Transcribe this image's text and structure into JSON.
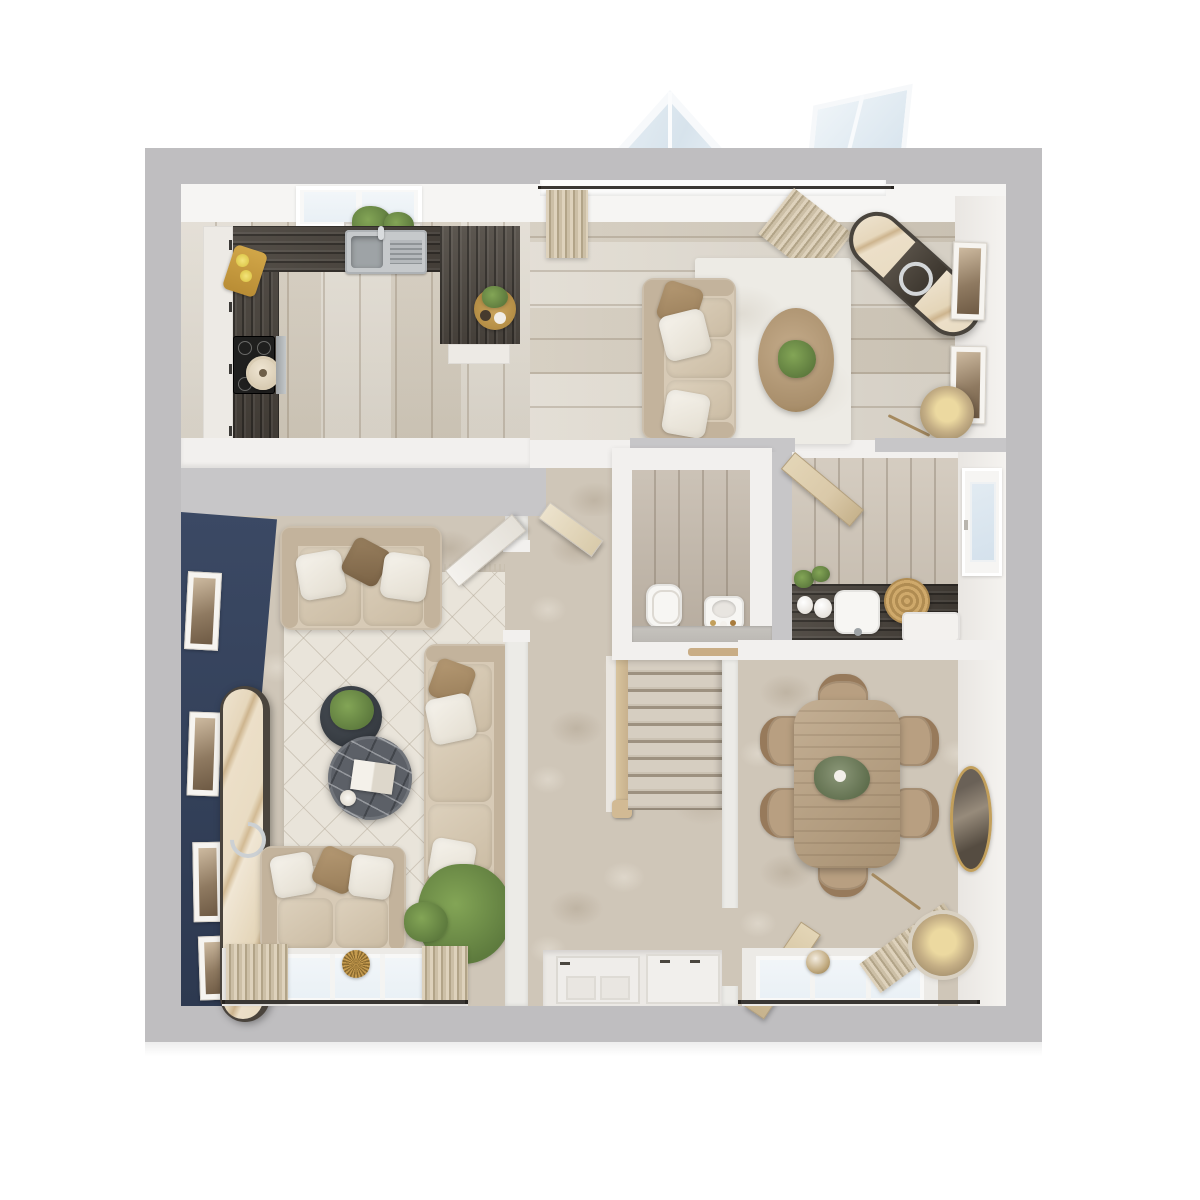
{
  "meta": {
    "kind": "3d-floor-plan-render",
    "view": "top-down-dollhouse",
    "text_visible": false
  },
  "palette": {
    "page_bg": "#ffffff",
    "wall_outer": "#bfbec0",
    "wall_core": "#c7c6c8",
    "wall_face": "#f2f0ee",
    "ceiling_face": "#f6f5f3",
    "wood_floor": "#d7d0c3",
    "wood_wc": "#c2b7a9",
    "counter_dark": "#453f38",
    "cabinet_white": "#edeae5",
    "carpet": "#cfc6b8",
    "navy_wall": "#3b4964",
    "navy_dark": "#2d3950",
    "rug_light": "#e9e4da",
    "rug_family": "#edebe5",
    "sofa": "#d7cab6",
    "sofa_shade": "#c3b39c",
    "pillow_white": "#f3f0ea",
    "pillow_tan": "#a98c66",
    "pillow_brown": "#8b7152",
    "table_wood": "#b69d7c",
    "chair_wood": "#b89f81",
    "marble_dark": "#5c6067",
    "gold": "#c29f5b",
    "glass": "#e9f0f5",
    "glass_blue": "#d4e1ec",
    "curtain": "#cfc2ab",
    "stair_rail": "#c8b18d",
    "door_wood": "#dac9a9",
    "door_white": "#efedea",
    "rod_dark": "#3a3733",
    "plant_green": "#5e7b3e",
    "plant_light": "#83a556",
    "stone": "#bcb9b4",
    "steel": "#c6c9cb"
  },
  "structure": {
    "rooms": [
      {
        "id": "kitchen",
        "position": "top-left",
        "floor": "light-timber",
        "fixtures": [
          "u-shaped-dark-worktop",
          "white-cabinet-run",
          "inset-sink-with-drainer",
          "induction-hob",
          "stock-pot",
          "chopping-board-with-lemons",
          "round-serving-board",
          "round-herb-board",
          "roof-window",
          "herb-planter"
        ]
      },
      {
        "id": "family-area",
        "position": "top-right",
        "floor": "light-timber",
        "fixtures": [
          "three-seat-sofa",
          "oval-timber-coffee-table",
          "potted-plant",
          "area-rug",
          "angled-marble-console",
          "floor-lamp",
          "two-wall-frames",
          "window-with-curtains",
          "roof-lantern-above"
        ]
      },
      {
        "id": "living-room",
        "position": "bottom-left",
        "floor": "carpet",
        "fixtures": [
          "navy-accent-wall",
          "four-wall-frames",
          "marble-capsule-console",
          "two-seat-sofa-top",
          "three-seat-sofa-right",
          "loveseat",
          "round-marble-coffee-table",
          "round-dark-side-table",
          "diamond-pattern-rug",
          "potted-plant",
          "window-with-curtains",
          "sunburst-ornament"
        ]
      },
      {
        "id": "hall",
        "position": "centre",
        "floor": "carpet",
        "fixtures": [
          "staircase",
          "timber-handrail",
          "newel-post",
          "front-door",
          "hall-cupboard"
        ]
      },
      {
        "id": "wc",
        "position": "centre",
        "floor": "timber",
        "fixtures": [
          "toilet",
          "vanity-basin",
          "stone-ledge",
          "timber-tray"
        ]
      },
      {
        "id": "utility",
        "position": "centre-right",
        "floor": "timber",
        "fixtures": [
          "dark-worktop",
          "inset-sink",
          "woven-basket",
          "two-vases",
          "two-plants",
          "white-appliance",
          "glazed-back-door"
        ]
      },
      {
        "id": "dining-room",
        "position": "bottom-right",
        "floor": "carpet",
        "fixtures": [
          "rectangular-timber-table",
          "six-dining-chairs",
          "eucalyptus-centrepiece",
          "oval-gold-mirror",
          "drum-floor-lamp",
          "window-with-curtain",
          "glass-ornament"
        ]
      }
    ],
    "doors": [
      "hall-to-family-open",
      "living-room-open",
      "utility-open",
      "dining-open",
      "front-door",
      "glazed-back-door"
    ],
    "windows": [
      "family-top-window",
      "living-bottom-window",
      "dining-bottom-window",
      "kitchen-roof-window",
      "roof-lantern-a",
      "roof-lantern-b"
    ],
    "counts": {
      "stair_treads": 9,
      "dining_chairs": 6,
      "living_wall_frames": 4,
      "family_wall_frames": 2,
      "living_window_panes": 3,
      "dining_window_panes": 3,
      "sofas_total": 4
    }
  }
}
